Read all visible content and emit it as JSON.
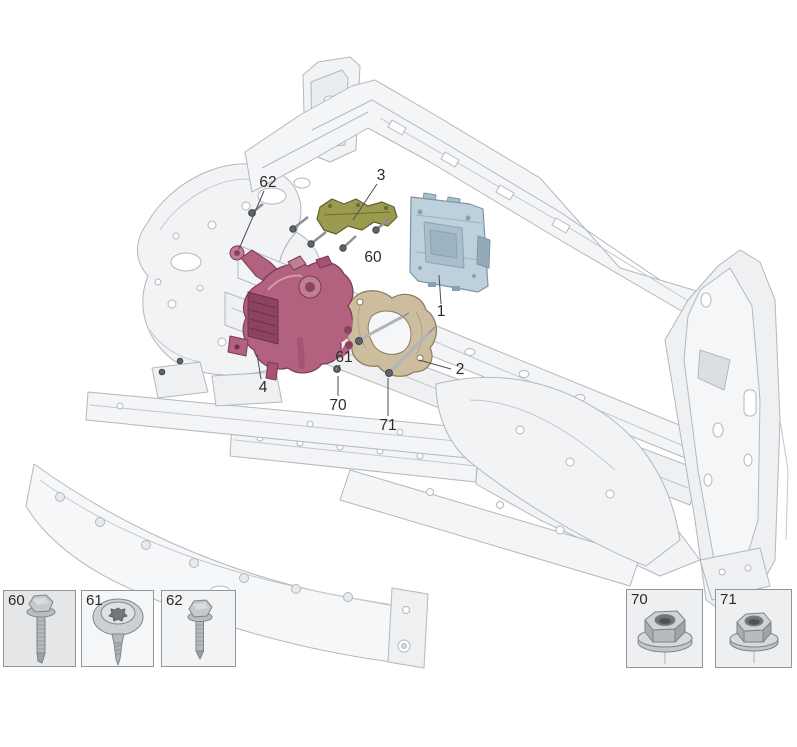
{
  "diagram": {
    "labels": {
      "c1": "1",
      "c2": "2",
      "c3": "3",
      "c4": "4",
      "c60": "60",
      "c61": "61",
      "c62": "62",
      "c70": "70",
      "c71": "71"
    },
    "parts": {
      "p1": {
        "callout": "1",
        "icon": "control-module"
      },
      "p2": {
        "callout": "2",
        "icon": "support-bracket"
      },
      "p3": {
        "callout": "3",
        "icon": "upper-bracket"
      },
      "p4": {
        "callout": "4",
        "icon": "coolant-valve-assembly"
      }
    }
  },
  "fasteners": {
    "left": [
      {
        "label": "60",
        "icon": "hex-flange-bolt-icon"
      },
      {
        "label": "61",
        "icon": "torx-pan-head-screw-icon"
      },
      {
        "label": "62",
        "icon": "hex-flange-bolt-icon"
      }
    ],
    "right": [
      {
        "label": "70",
        "icon": "hex-flange-nut-icon"
      },
      {
        "label": "71",
        "icon": "hex-flange-nut-icon"
      }
    ]
  },
  "colors": {
    "part1_module": "#bdd0db",
    "part2_bracket": "#cdbd9f",
    "part3_bracket": "#9b9b50",
    "part4_valve": "#b2617e",
    "frame_line": "#b2b8be",
    "callout_text": "#2b2b2b"
  }
}
